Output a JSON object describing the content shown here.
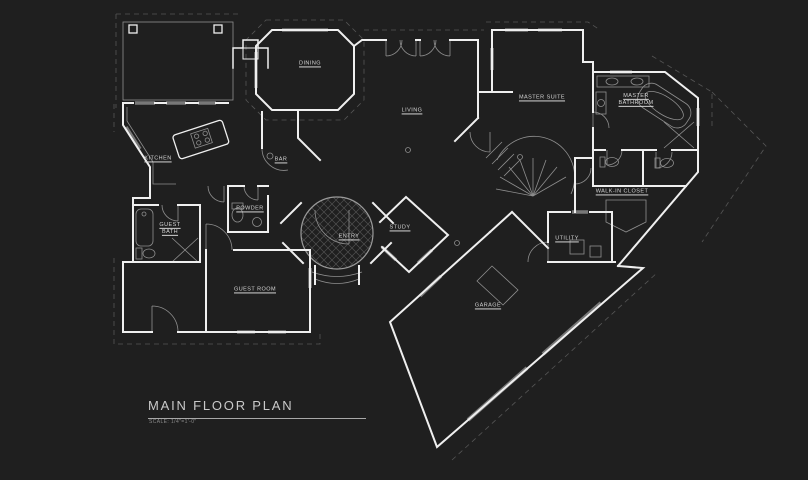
{
  "drawing": {
    "title": "MAIN FLOOR PLAN",
    "scale_note": "SCALE: 1/4\"=1'-0\"",
    "colors": {
      "background": "#1f1f1f",
      "wall_line": "#efefef",
      "detail_line": "#8f8f8f",
      "overhang_dash": "#565656",
      "window_fill": "#787878",
      "label_text": "#d4d4d4",
      "title_text": "#c9c9c9"
    }
  },
  "rooms": {
    "dining": {
      "label": "DINING"
    },
    "living": {
      "label": "LIVING"
    },
    "master_suite": {
      "label": "MASTER SUITE"
    },
    "master_bathroom": {
      "label": "MASTER BATHROOM"
    },
    "kitchen": {
      "label": "KITCHEN"
    },
    "bar": {
      "label": "BAR"
    },
    "powder": {
      "label": "POWDER"
    },
    "guest_bath": {
      "label": "GUEST BATH"
    },
    "entry": {
      "label": "ENTRY"
    },
    "study": {
      "label": "STUDY"
    },
    "walk_in_closet": {
      "label": "WALK-IN CLOSET"
    },
    "utility": {
      "label": "UTILITY"
    },
    "guest_room": {
      "label": "GUEST ROOM"
    },
    "garage": {
      "label": "GARAGE"
    }
  }
}
